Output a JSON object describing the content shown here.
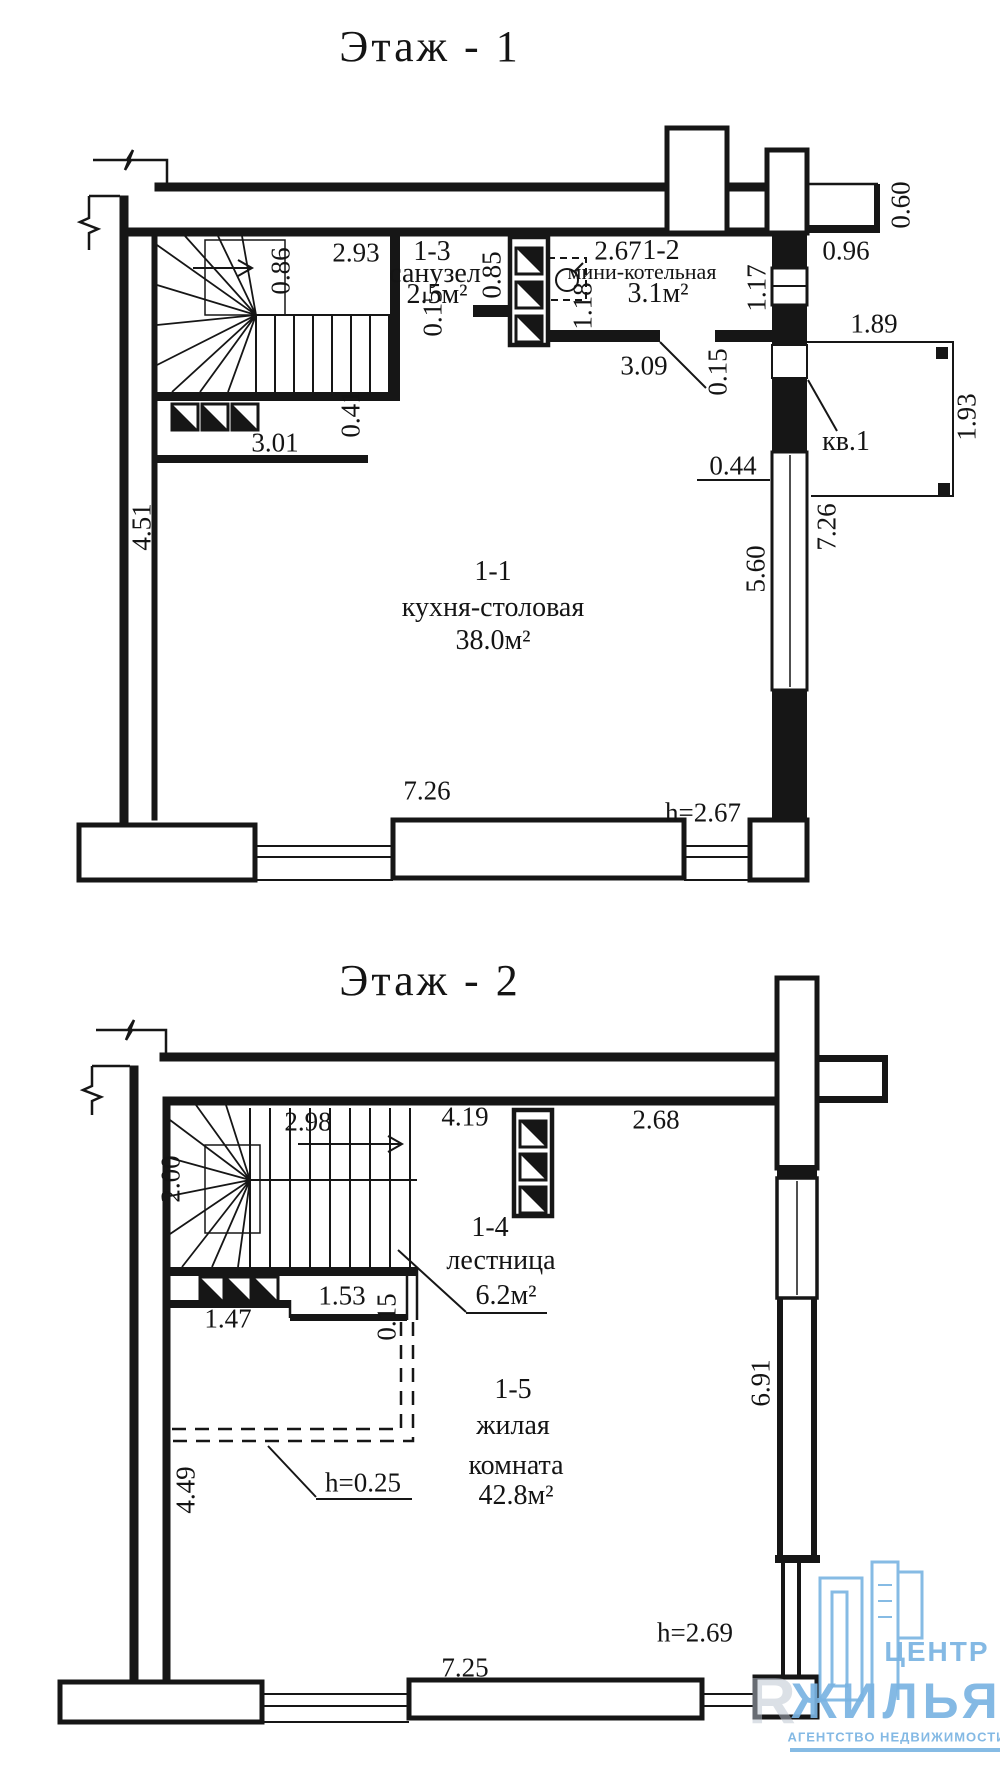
{
  "document": {
    "background": "#ffffff",
    "ink": "#141414"
  },
  "floor1": {
    "title": "Этаж - 1",
    "rooms": [
      {
        "code": "1-1",
        "name": "кухня-столовая",
        "area": "38.0м²"
      },
      {
        "code": "1-2",
        "name": "мини-котельная",
        "area": "3.1м²"
      },
      {
        "code": "1-3",
        "name": "санузел",
        "area": "2.5м²"
      }
    ],
    "apartment_label": "кв.1",
    "ceiling_height": "h=2.67",
    "dims": {
      "stair_width": "2.93",
      "stair_top": "0.86",
      "shaft_side": "0.85",
      "boiler_top": "2.67",
      "boiler_side": "1.18",
      "wc_wall": "0.15",
      "boiler_bottom": "3.09",
      "entry_wall": "0.15",
      "window_small": "1.17",
      "chimney_side": "0.60",
      "ledge": "0.96",
      "porch_width": "1.89",
      "porch_depth": "1.93",
      "window_offset": "0.44",
      "window_len": "5.60",
      "right_height": "7.26",
      "left_height": "4.51",
      "stair_bottom": "3.01",
      "stair_ledge": "0.41",
      "bottom_width": "7.26"
    }
  },
  "floor2": {
    "title": "Этаж - 2",
    "rooms": [
      {
        "code": "1-4",
        "name": "лестница",
        "area": "6.2м²"
      },
      {
        "code": "1-5",
        "name": "жилая",
        "name2": "комната",
        "area": "42.8м²"
      }
    ],
    "ceiling_height": "h=2.69",
    "low_ceiling": "h=0.25",
    "dims": {
      "stair_top1": "2.98",
      "stair_top2": "4.19",
      "top_right": "2.68",
      "stair_left": "2.00",
      "stair_bot1": "1.47",
      "stair_bot2": "1.53",
      "thin_wall": "0.15",
      "left_height": "4.49",
      "right_height": "6.91",
      "bottom_width": "7.25"
    }
  },
  "logo": {
    "line1": "ЦЕНТР",
    "line2": "ЖИЛЬЯ",
    "line3": "АГЕНТСТВО НЕДВИЖИМОСТИ",
    "watermark": "R",
    "color": "#7ab4e2"
  }
}
